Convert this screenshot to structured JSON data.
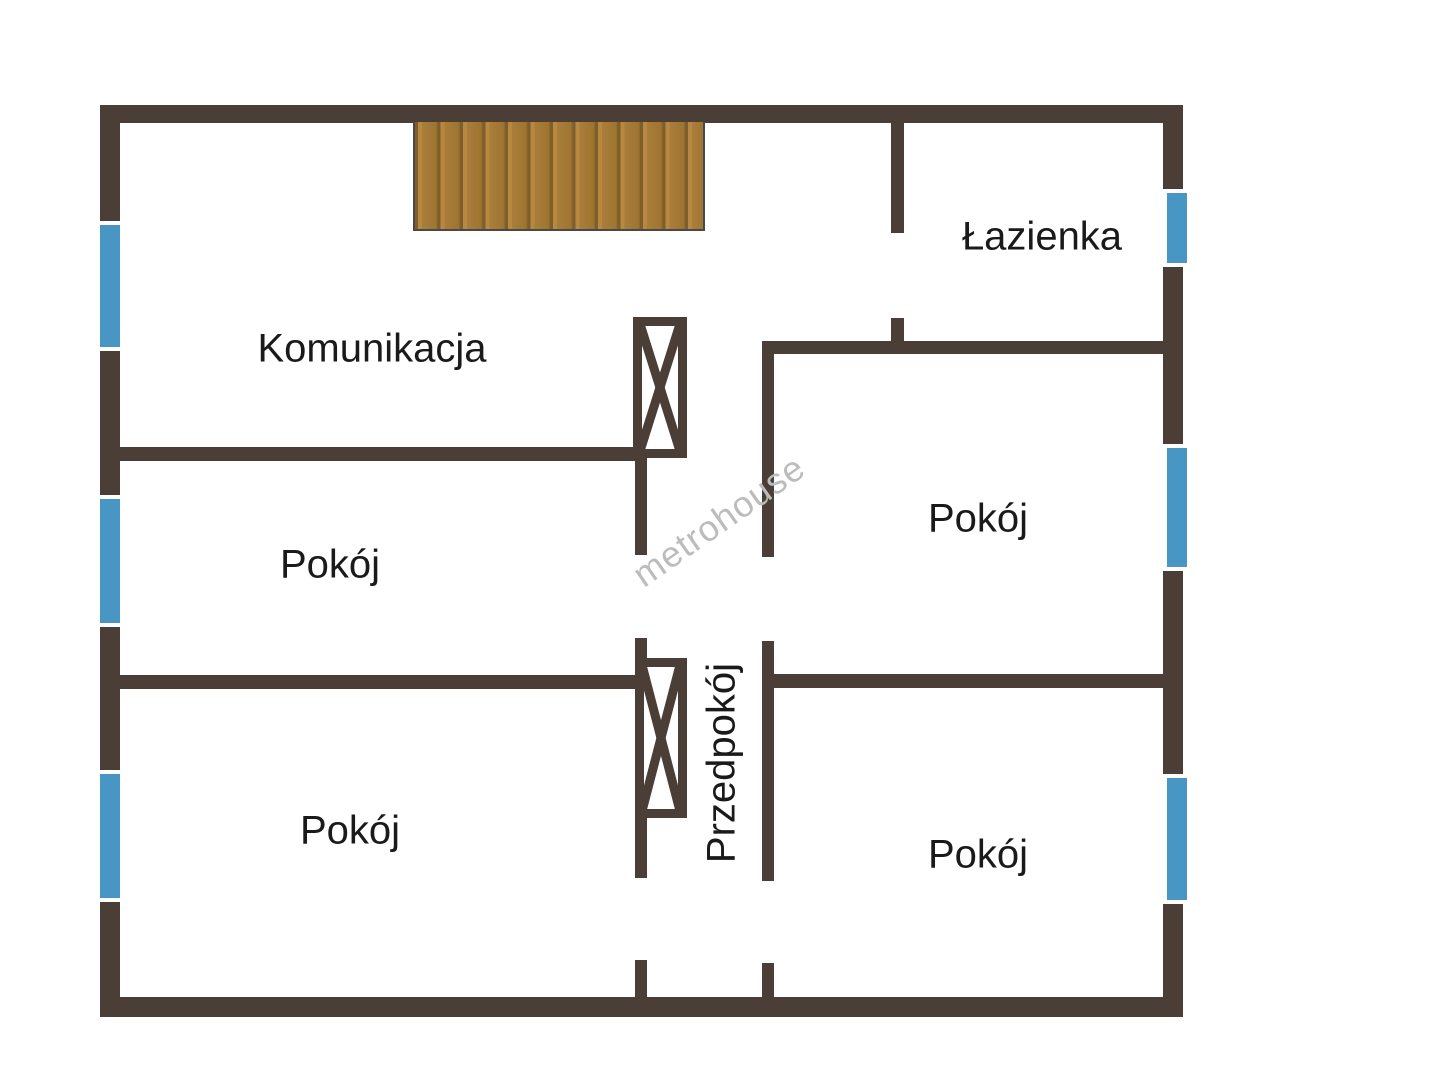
{
  "plan": {
    "type": "apartment-floor-plan",
    "watermark": "metrohouse",
    "rooms": {
      "komunikacja": "Komunikacja",
      "lazienka": "Łazienka",
      "pokoj_middle_left": "Pokój",
      "pokoj_top_right": "Pokój",
      "pokoj_bottom_left": "Pokój",
      "pokoj_bottom_right": "Pokój",
      "przedpokoj": "Przedpokój"
    },
    "colors": {
      "wall": "#4a3e36",
      "window": "#4796c3",
      "stairs_wood": "#aa7d3b",
      "stairs_groove": "#7f5e2b",
      "label_text": "#1a1a1a",
      "watermark": "#bcbcbc",
      "background": "#ffffff"
    },
    "features": {
      "window_count": 6,
      "chimney_flue_count": 2,
      "stairs": "wooden stairs, top center"
    }
  }
}
